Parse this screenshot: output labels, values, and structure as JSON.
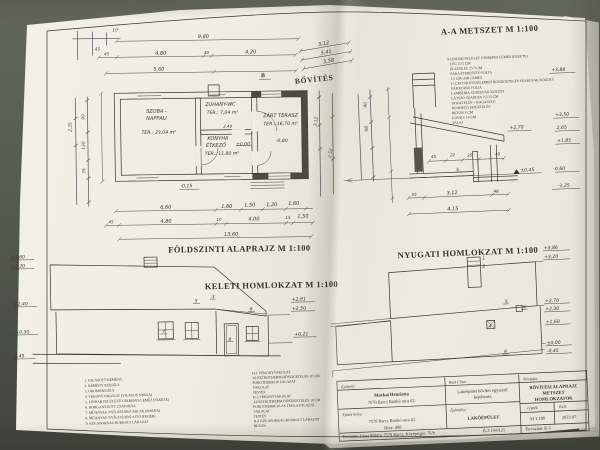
{
  "photo": {
    "table_color": "#53564c",
    "paper_color": "#efece1"
  },
  "plan": {
    "title": "FÖLDSZINTI ALAPRAJZ M 1:100",
    "extension_label": "BŐVÍTÉS",
    "section_mark_b": "B",
    "rooms": {
      "living": {
        "name1": "SZOBA -",
        "name2": "NAPPALI",
        "area": "TER.: 23,04 m²"
      },
      "shower": {
        "name": "ZUHANY-WC",
        "area": "TER.: 7,04 m²"
      },
      "kitchen": {
        "name1": "KONYHA",
        "name2": "ÉTKEZŐ",
        "area": "TER.: 11,80 m²",
        "level": "±0,00",
        "dim": "2,40"
      },
      "terrace": {
        "name": "ZÁRT TERASZ",
        "area": "TER.: 16,70 m²",
        "level": "-0,80"
      }
    },
    "dims_top": {
      "total": "9,80",
      "row2": [
        "45",
        "4,80",
        "40",
        "4,20"
      ],
      "row3": [
        "5,60"
      ],
      "fold": [
        "3,12",
        "3,41",
        "3,58"
      ]
    },
    "dims_bottom": {
      "row1": [
        "6,60",
        "1,80",
        "1,50",
        "1,20",
        "1,60"
      ],
      "row2": [
        "45",
        "4,80",
        "10",
        "4,00",
        "15",
        "1,50"
      ],
      "total": "13,60"
    },
    "level_note": "-0,15",
    "pen_dims": [
      "10",
      "45",
      "2,35",
      "90",
      "130",
      "35",
      "3,12",
      "2,52"
    ]
  },
  "section": {
    "title": "A-A METSZET M 1:100",
    "layers": [
      "A LINDAB FELÜLET CSEREPES LEMEZ (FEKETE)",
      "LÉC 25/5 CM",
      "ELLENLÉC 25/5 CM",
      "PÁRAÁTERESZTŐ FÓLIA",
      "1,5 CM OSB LEMEZ",
      "15 CM TARTÓSZELEMEN HŐSZIGETELÉS SZARUFÁK KÖZÖTT",
      "PÁRAZÁRÓ FÓLIA",
      "LAMBÉRIA SZARUFÁK KÖZÖTT",
      "LÁTSZÓ SZARUFA 7,5/15 CM",
      "SZIGETELÉS + RAGASZTÓ",
      "KENHETŐ SZIGETELÉS",
      "BETON 8 CM",
      "KAVICS 10 CM",
      "TALAJ"
    ],
    "marks": {
      "ridge": "+3,86",
      "left": "+2,70",
      "r1": "+3,50",
      "r2": "2,65",
      "r3": "+1,85",
      "datum": "±0,45",
      "r4": "-0,60",
      "r5": "-1,25"
    },
    "dims": {
      "b1": "55",
      "b2": "3,12",
      "b3": "48",
      "total": "4,15",
      "small": [
        "45",
        "22",
        "35",
        "40"
      ],
      "ref": "5"
    },
    "pen": [
      "40",
      "98"
    ]
  },
  "east": {
    "title": "KELETI HOMLOKZAT M 1:100",
    "marks_left": [
      "+3,60",
      "+3,20",
      "+2,40",
      "+0,30",
      "-0,45"
    ],
    "marks_right": [
      "+2,81",
      "+2,50",
      "+0,21"
    ],
    "refs": [
      "5",
      "3",
      "6",
      "7",
      "8"
    ]
  },
  "west": {
    "title": "NYUGATI HOMLOKZAT M 1:100",
    "marks_right": [
      "+3,86",
      "+3,20",
      "+2,70",
      "+2,30",
      "+1,60",
      "±0,00",
      "-0,45"
    ],
    "refs": [
      "1",
      "2",
      "5",
      "6",
      "4",
      "9"
    ]
  },
  "legend": {
    "numbered": [
      "1. FALAZOTT KÉMÉNY",
      "2. KÉMÉNY SZEGÉLY",
      "3. OROMSZEGÉLY",
      "4. VÉKONYVAKOLAT (VILÁGOS SÁRGA)",
      "5. LINDAB FELÜLETŰ CSEREPES LEMEZ (FEKETE)",
      "6. HORGANYZOTT CSATORNA",
      "7. MŰANYAG NYÍLÁSZÁRÓ ABLAK (BARNA)",
      "8. MŰANYAG NYÍLÁSZÁRÓ AJTÓ (FEHÉR)",
      "9. KŐLAPOKKAL BURKOLT LÁBAZAT"
    ],
    "layers_h": [
      "H-1 VÉKONYVAKOLAT",
      "AUSZTROTHERM HŐSZIGETELÉS 10 CM",
      "POROTHERM 30 FALAZAT",
      "VAKOLAT",
      "FESTÉS",
      "H-2 VÉKONYVAKOLAT",
      "AUSZTROTHERM HŐSZIGETELÉS 10 CM",
      "POROTHERM 30-AS TÉGLA FALAZAT",
      "VAKOLAT",
      "FESTÉS",
      "H-3 KŐLAPOKKAL BURKOLT LÁBAZAT",
      "BETON"
    ]
  },
  "titleblock": {
    "client_label": "Építtető:",
    "client_name": "Markai Henrietta",
    "client_addr": "7570 Barcs Bimbó utca 62.",
    "site_label": "Építés helye:",
    "site_addr": "7570 Barcs Bimbó utca 62.",
    "site_lot": "Hrsz: 400",
    "drawing_label": "Rajz Címe:",
    "drawing_line1": "Lakóépület bővítés egyszerű",
    "drawing_line2": "bejelentés",
    "building_label": "Építmény:",
    "building_value": "LAKÓÉPÜLET",
    "type_label": "Tervfajta:",
    "type_line1": "BŐVÍTÉSI ALAPRAJZ",
    "type_line2": "METSZET",
    "type_line3": "HOMLOKZATOK",
    "scale_label": "Lépték",
    "scale_value": "M 1:100",
    "date_label": "Kelt:",
    "date_value": "2023.07.",
    "designer": "Tervezte: Utasi Miklós 7570 Barcs, Középrigóc 76/b.",
    "designer_reg": "É-3 14-0121",
    "plan_no": "Tervszám: É-3"
  }
}
